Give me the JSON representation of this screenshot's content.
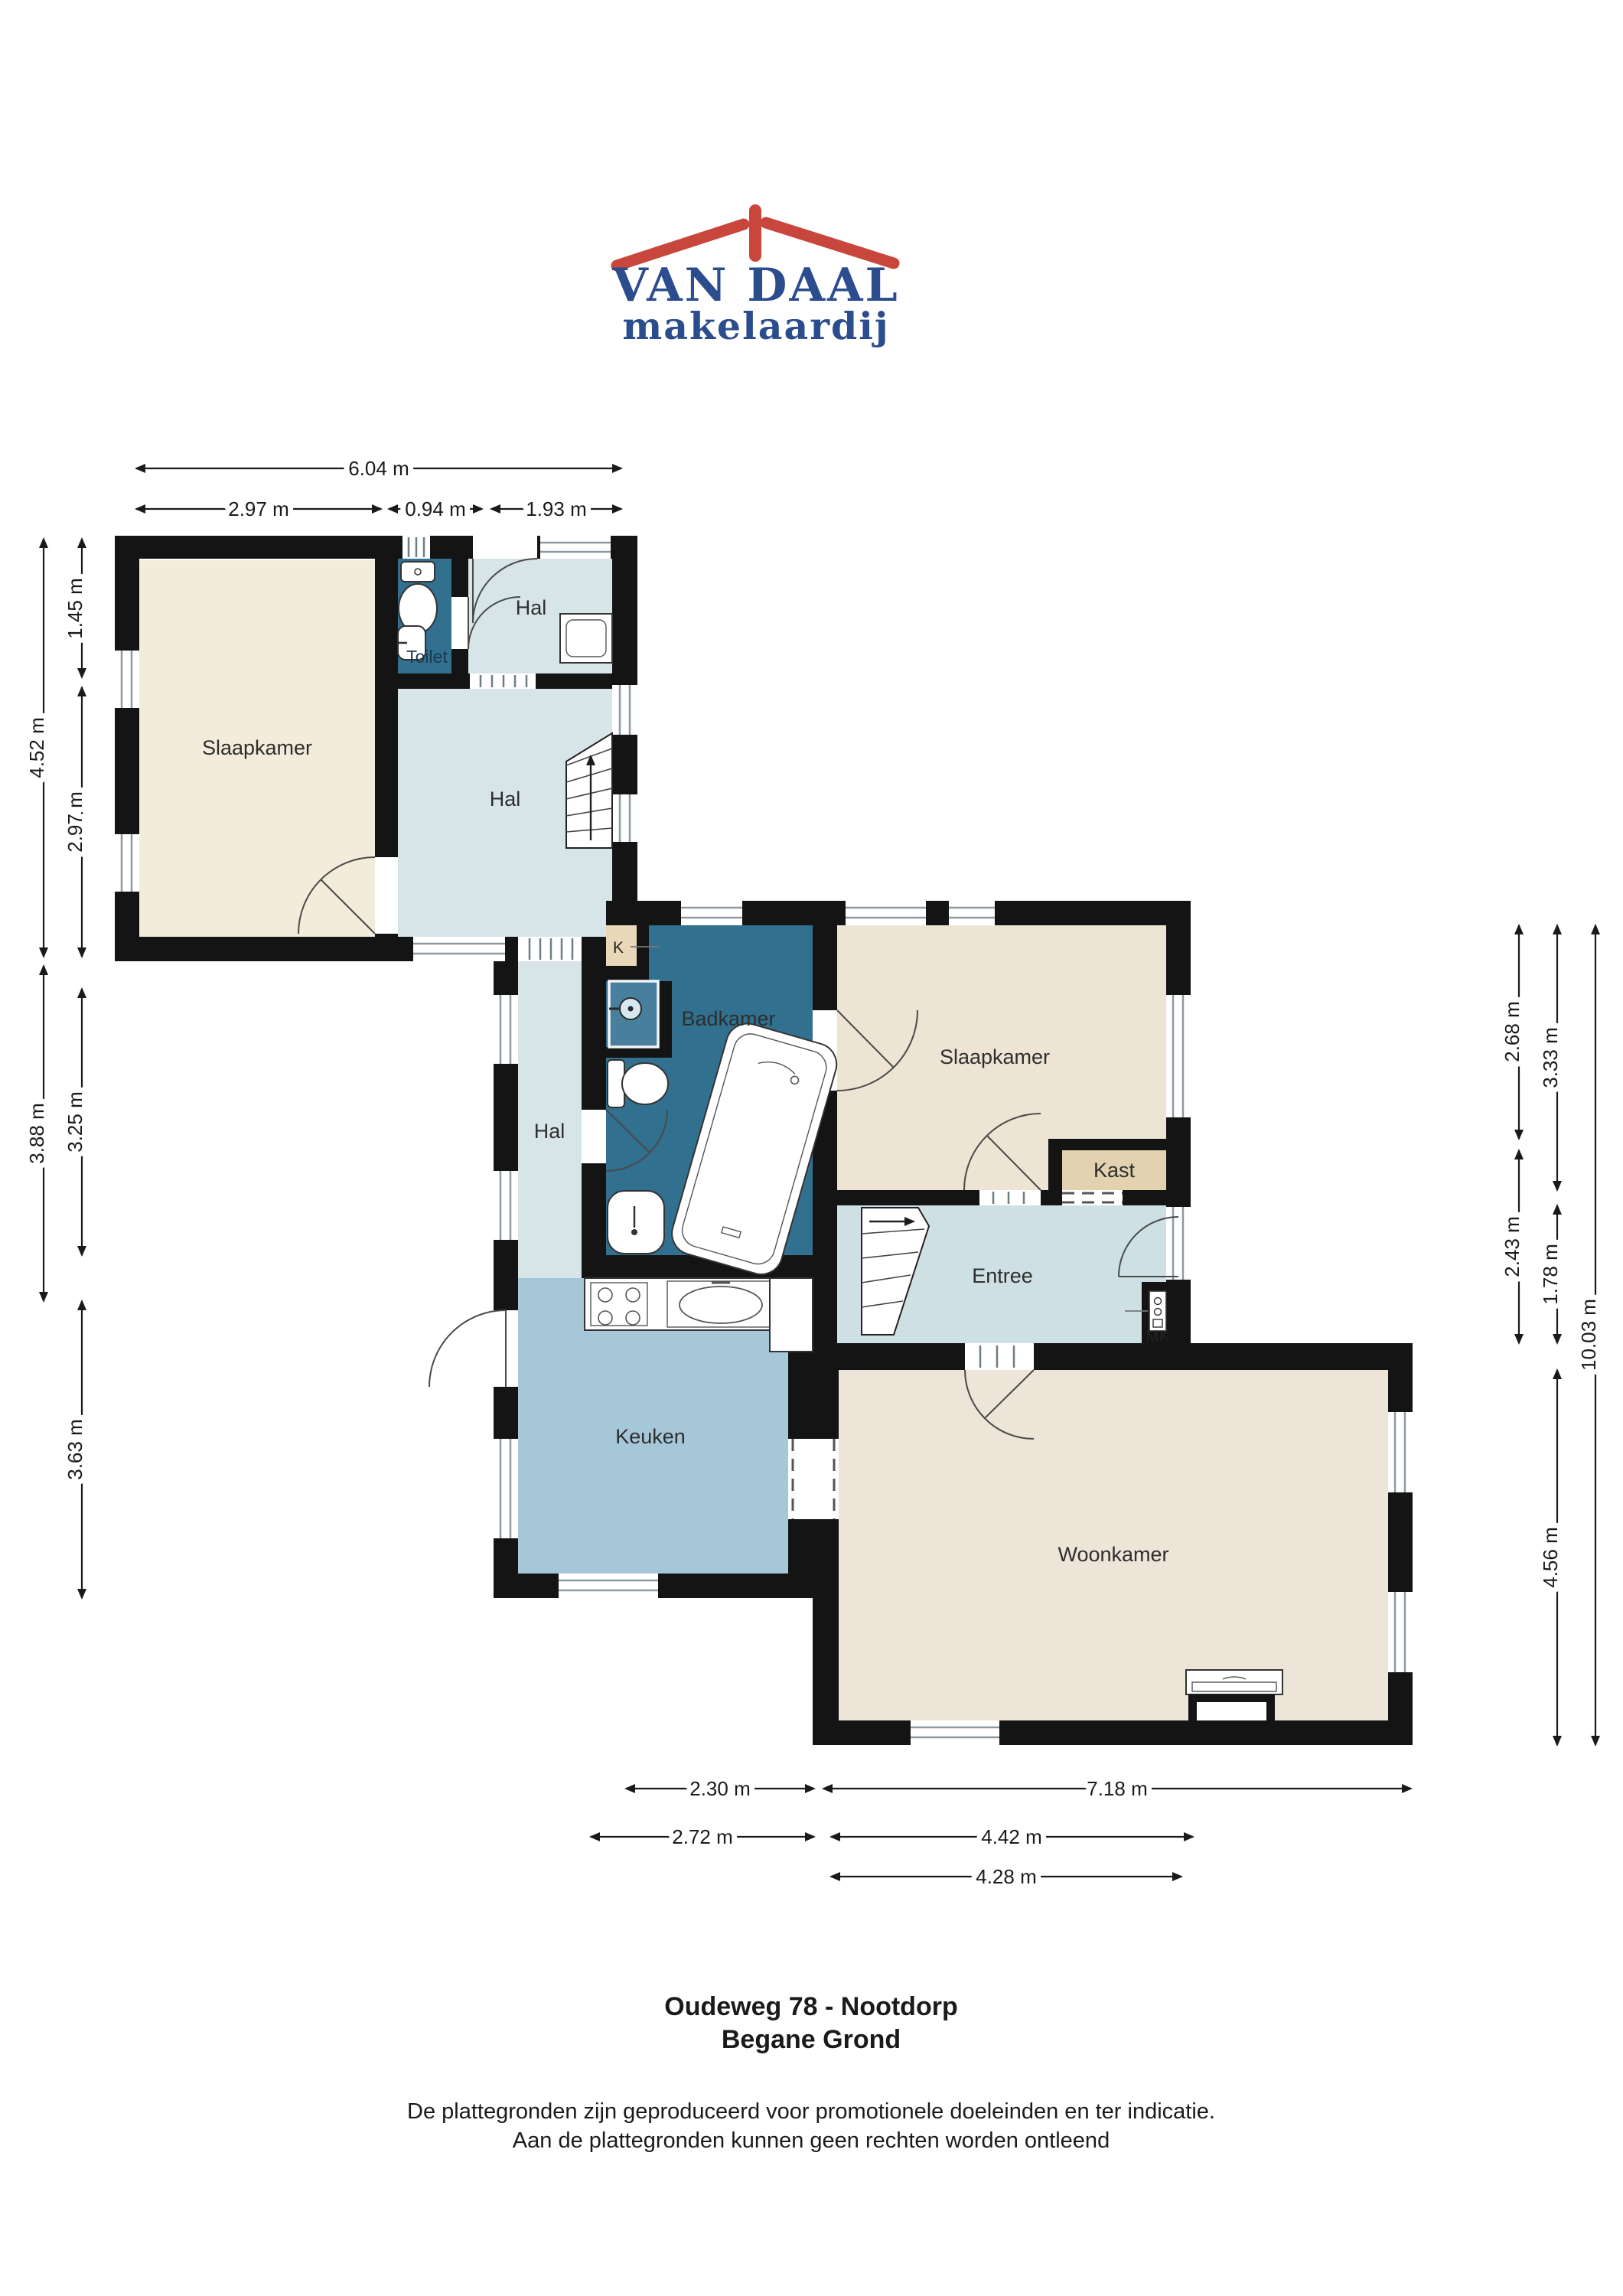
{
  "logo": {
    "name": "VAN DAAL",
    "tagline": "makelaardij"
  },
  "rooms": {
    "slaapkamer1": {
      "label": "Slaapkamer"
    },
    "toilet": {
      "label": "Toilet"
    },
    "hal_boven": {
      "label": "Hal"
    },
    "hal": {
      "label": "Hal"
    },
    "hal_gang": {
      "label": "Hal"
    },
    "k": {
      "label": "K"
    },
    "badkamer": {
      "label": "Badkamer"
    },
    "slaapkamer2": {
      "label": "Slaapkamer"
    },
    "kast": {
      "label": "Kast"
    },
    "entree": {
      "label": "Entree"
    },
    "mk": {
      "label": "MK"
    },
    "keuken": {
      "label": "Keuken"
    },
    "woonkamer": {
      "label": "Woonkamer"
    }
  },
  "dimensions": {
    "top_total": "6.04 m",
    "top_parts": [
      "2.97 m",
      "0.94 m",
      "1.93 m"
    ],
    "left_outer": [
      "4.52 m",
      "3.88 m"
    ],
    "left_inner": [
      "1.45 m",
      "2.97 m",
      "3.25 m",
      "3.63 m"
    ],
    "right_col1": [
      "2.68 m",
      "2.43 m"
    ],
    "right_col2": [
      "3.33 m",
      "1.78 m",
      "4.56 m"
    ],
    "right_total": "10.03 m",
    "bottom_row1": [
      "2.30 m",
      "7.18 m"
    ],
    "bottom_row2": [
      "2.72 m",
      "4.42 m"
    ],
    "bottom_row3": [
      "4.28 m"
    ]
  },
  "title": {
    "address": "Oudeweg 78 - Nootdorp",
    "floor": "Begane Grond"
  },
  "disclaimer": {
    "line1": "De plattegronden zijn geproduceerd voor promotionele doeleinden en ter indicatie.",
    "line2": "Aan de plattegronden kunnen geen rechten worden ontleend"
  },
  "colors": {
    "wall": "#141414",
    "bedroom1": "#f3ecda",
    "bedroom2": "#ede4d4",
    "living": "#ece5d8",
    "hall": "#d8e5e8",
    "entry": "#cfe0e4",
    "kitchen": "#a6c7d8",
    "bathroom": "#32708f",
    "shower": "#477f9d",
    "closet_k": "#e8d8b8",
    "closet_kast": "#e3d2b0",
    "brand_red": "#c9463c",
    "brand_blue": "#2b4d8e"
  }
}
